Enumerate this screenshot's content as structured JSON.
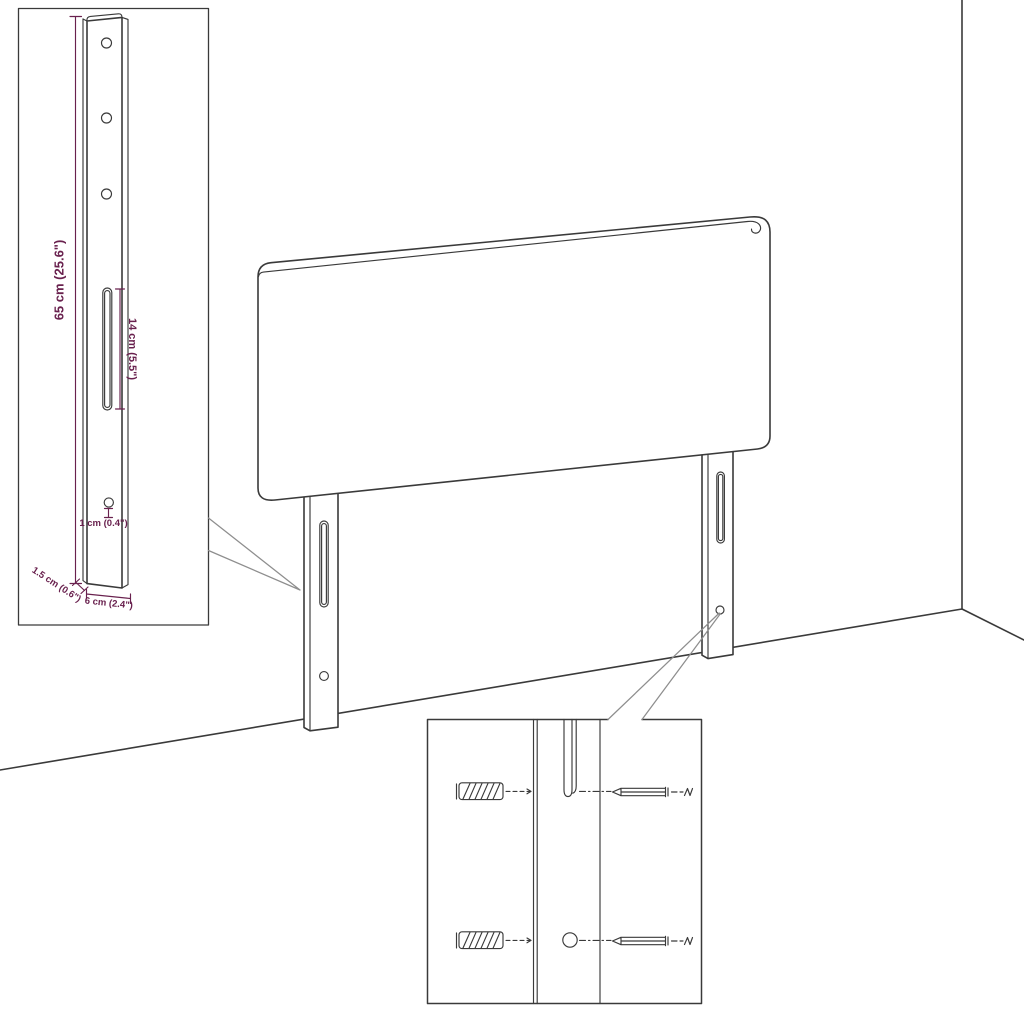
{
  "diagram": {
    "kind": "furniture-dimension-diagram",
    "subject": "upholstered headboard with two mounting legs, shown in a room corner",
    "colors": {
      "background": "#ffffff",
      "line": "#3a3a3a",
      "dimension": "#69214e",
      "callout": "#8e8e8e"
    },
    "dimensions": {
      "height": "65 cm (25.6\")",
      "slot_length": "14 cm (5.5\")",
      "hole_diameter": "1 cm (0.4\")",
      "thickness": "1.5 cm (0.6\")",
      "width": "6 cm (2.4\")"
    }
  }
}
